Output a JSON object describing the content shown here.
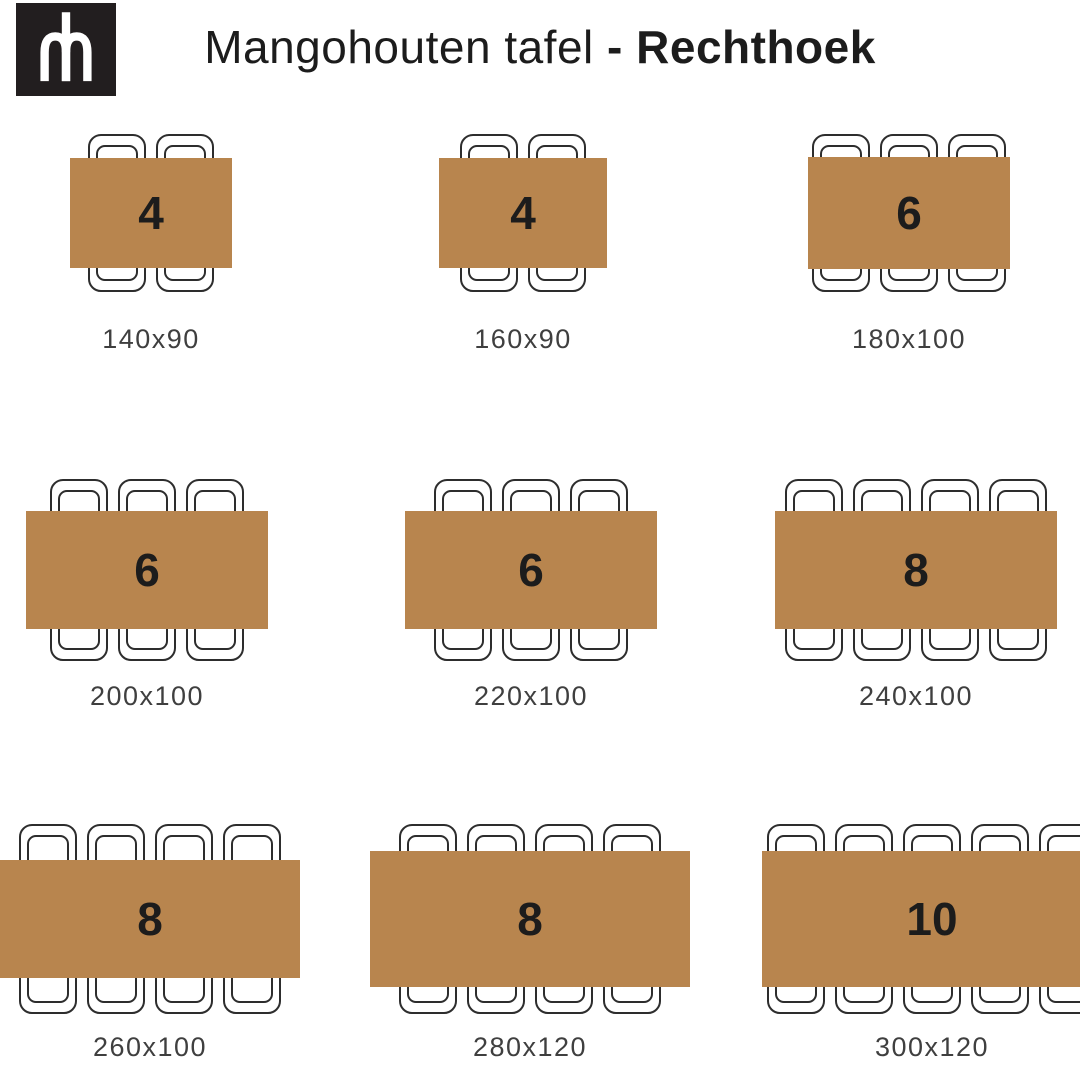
{
  "header": {
    "title_regular": "Mangohouten tafel ",
    "title_bold": "- Rechthoek",
    "logo_monogram": "mh"
  },
  "colors": {
    "table_top": "#b8854e",
    "chair_outline": "#2d2d2d",
    "seat_number": "#1c1c1c",
    "dimension_label": "#3f3f3f",
    "logo_background": "#221e1f",
    "logo_mark": "#ffffff"
  },
  "tables": [
    {
      "seats": 4,
      "dimensions": "140x90",
      "chairs_per_side": 2
    },
    {
      "seats": 4,
      "dimensions": "160x90",
      "chairs_per_side": 2
    },
    {
      "seats": 6,
      "dimensions": "180x100",
      "chairs_per_side": 3
    },
    {
      "seats": 6,
      "dimensions": "200x100",
      "chairs_per_side": 3
    },
    {
      "seats": 6,
      "dimensions": "220x100",
      "chairs_per_side": 3
    },
    {
      "seats": 8,
      "dimensions": "240x100",
      "chairs_per_side": 4
    },
    {
      "seats": 8,
      "dimensions": "260x100",
      "chairs_per_side": 4
    },
    {
      "seats": 8,
      "dimensions": "280x120",
      "chairs_per_side": 4
    },
    {
      "seats": 10,
      "dimensions": "300x120",
      "chairs_per_side": 5
    }
  ]
}
